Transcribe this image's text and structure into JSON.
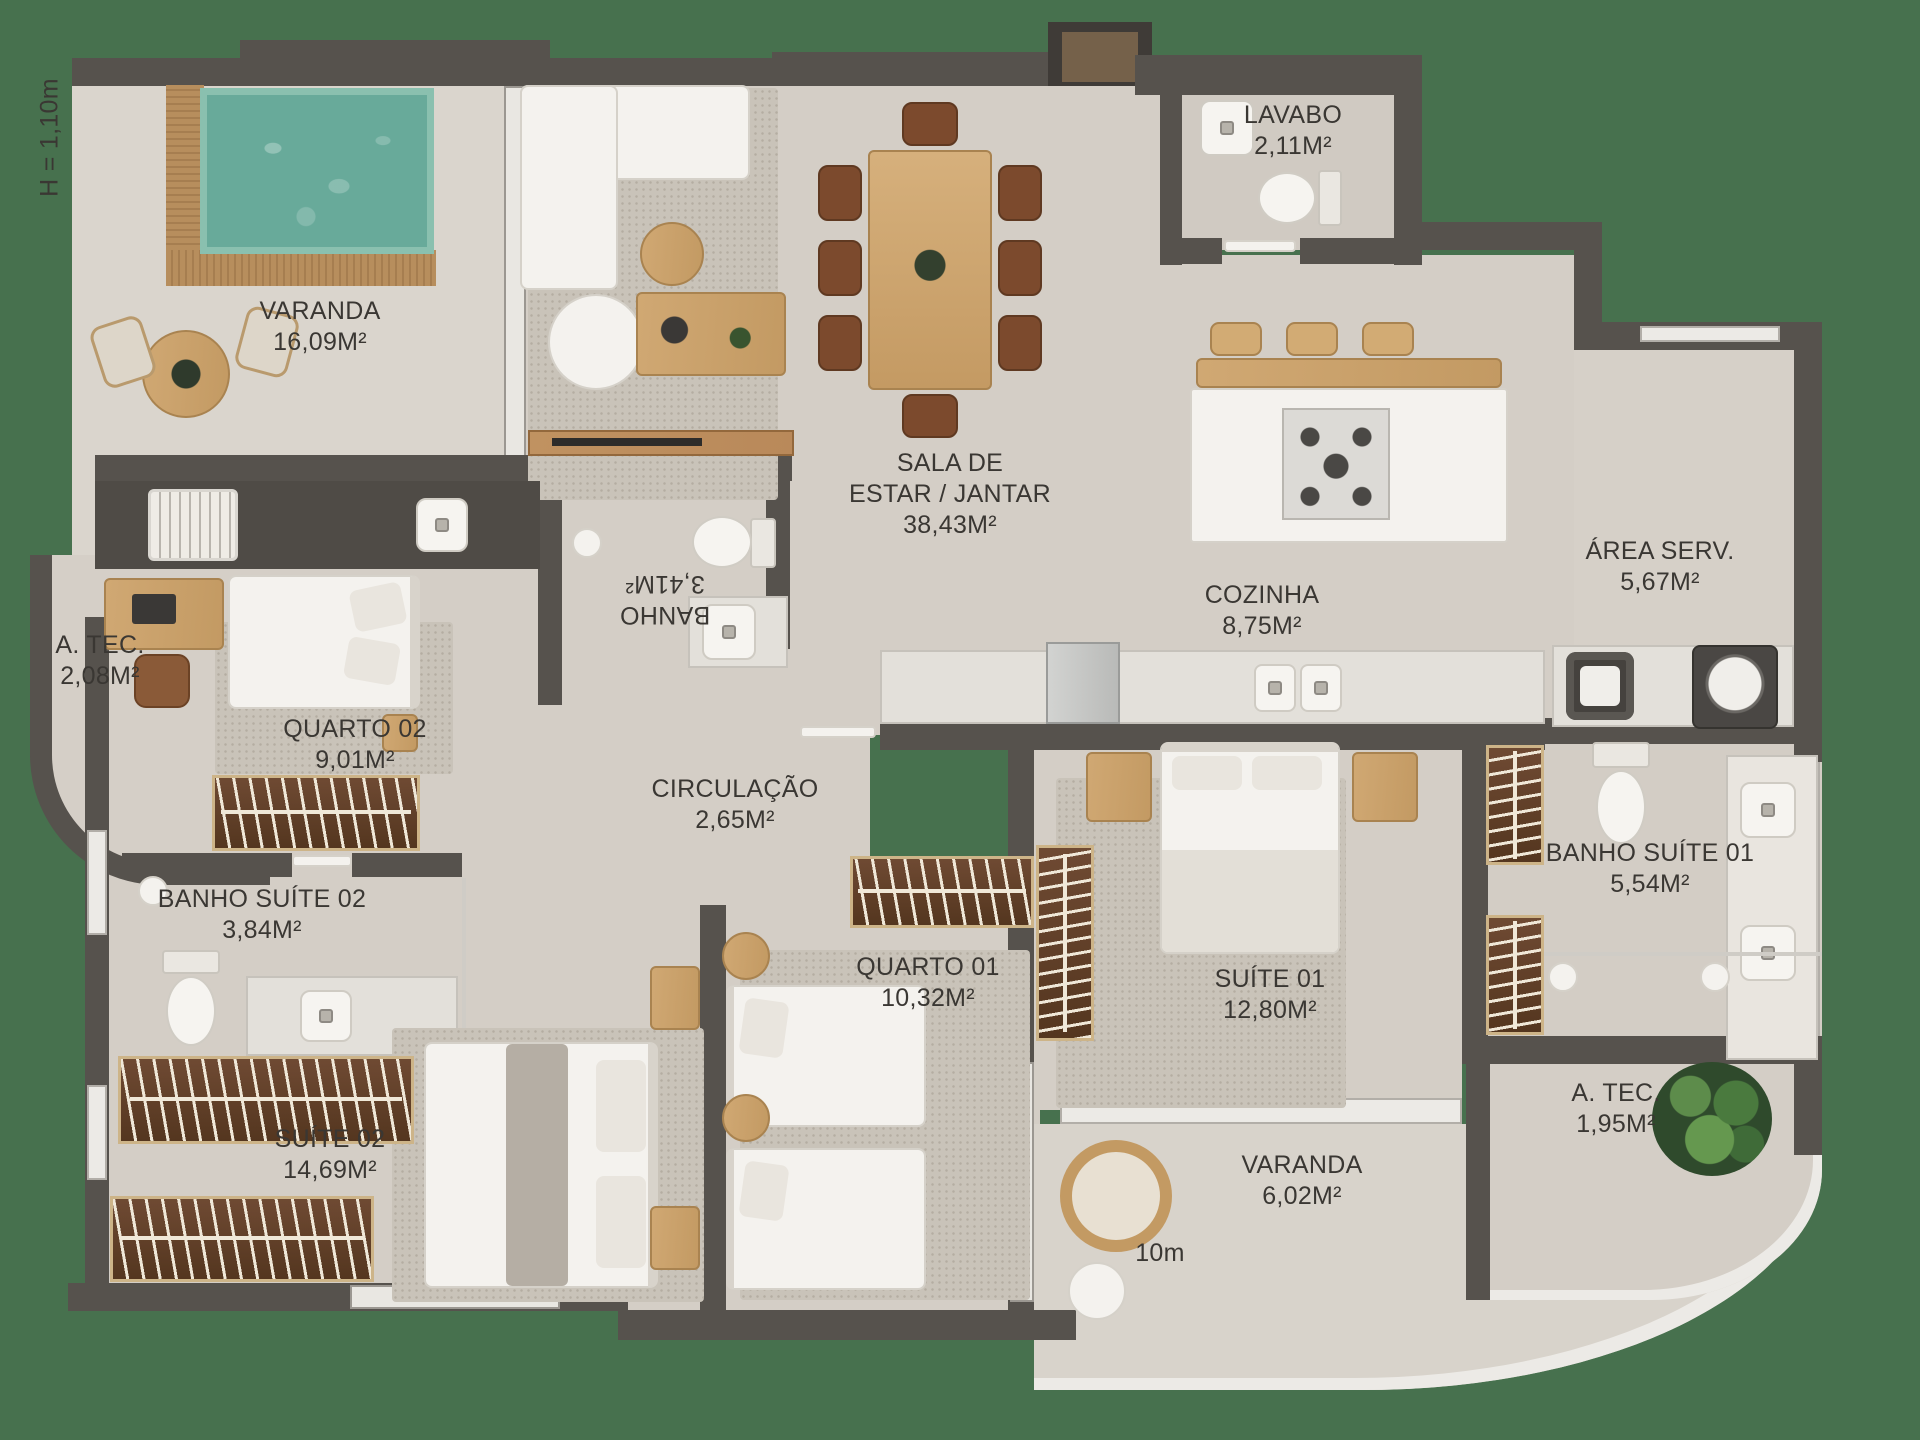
{
  "plan": {
    "annotations": {
      "height_note": "H = 1,10m",
      "scale_note": "10m"
    },
    "rooms": {
      "varanda_top": {
        "name": "VARANDA",
        "area": "16,09M²"
      },
      "sala": {
        "line1": "SALA DE",
        "line2": "ESTAR / JANTAR",
        "area": "38,43M²"
      },
      "lavabo": {
        "name": "LAVABO",
        "area": "2,11M²"
      },
      "area_serv": {
        "name": "ÁREA SERV.",
        "area": "5,67M²"
      },
      "cozinha": {
        "name": "COZINHA",
        "area": "8,75M²"
      },
      "atec_left": {
        "name": "A. TEC.",
        "area": "2,08M²"
      },
      "banho": {
        "name": "BANHO",
        "area": "3,41M²"
      },
      "quarto02": {
        "name": "QUARTO 02",
        "area": "9,01M²"
      },
      "circulacao": {
        "name": "CIRCULAÇÃO",
        "area": "2,65M²"
      },
      "banho_suite02": {
        "name": "BANHO SUÍTE 02",
        "area": "3,84M²"
      },
      "suite02": {
        "name": "SUÍTE 02",
        "area": "14,69M²"
      },
      "quarto01": {
        "name": "QUARTO 01",
        "area": "10,32M²"
      },
      "suite01": {
        "name": "SUÍTE 01",
        "area": "12,80M²"
      },
      "banho_suite01": {
        "name": "BANHO SUÍTE 01",
        "area": "5,54M²"
      },
      "atec_right": {
        "name": "A. TEC.",
        "area": "1,95M²"
      },
      "varanda_bottom": {
        "name": "VARANDA",
        "area": "6,02M²"
      }
    },
    "colors": {
      "background": "#47714e",
      "wall": "#56524d",
      "floor": "#d4cec6",
      "rug": "#c9c3b9",
      "pool_water": "#68aa9a",
      "wood": "#c9a36e",
      "wardrobe_wood": "#6f4a33",
      "fixture_white": "#f4f2ee",
      "label_text": "#3a3733"
    }
  }
}
